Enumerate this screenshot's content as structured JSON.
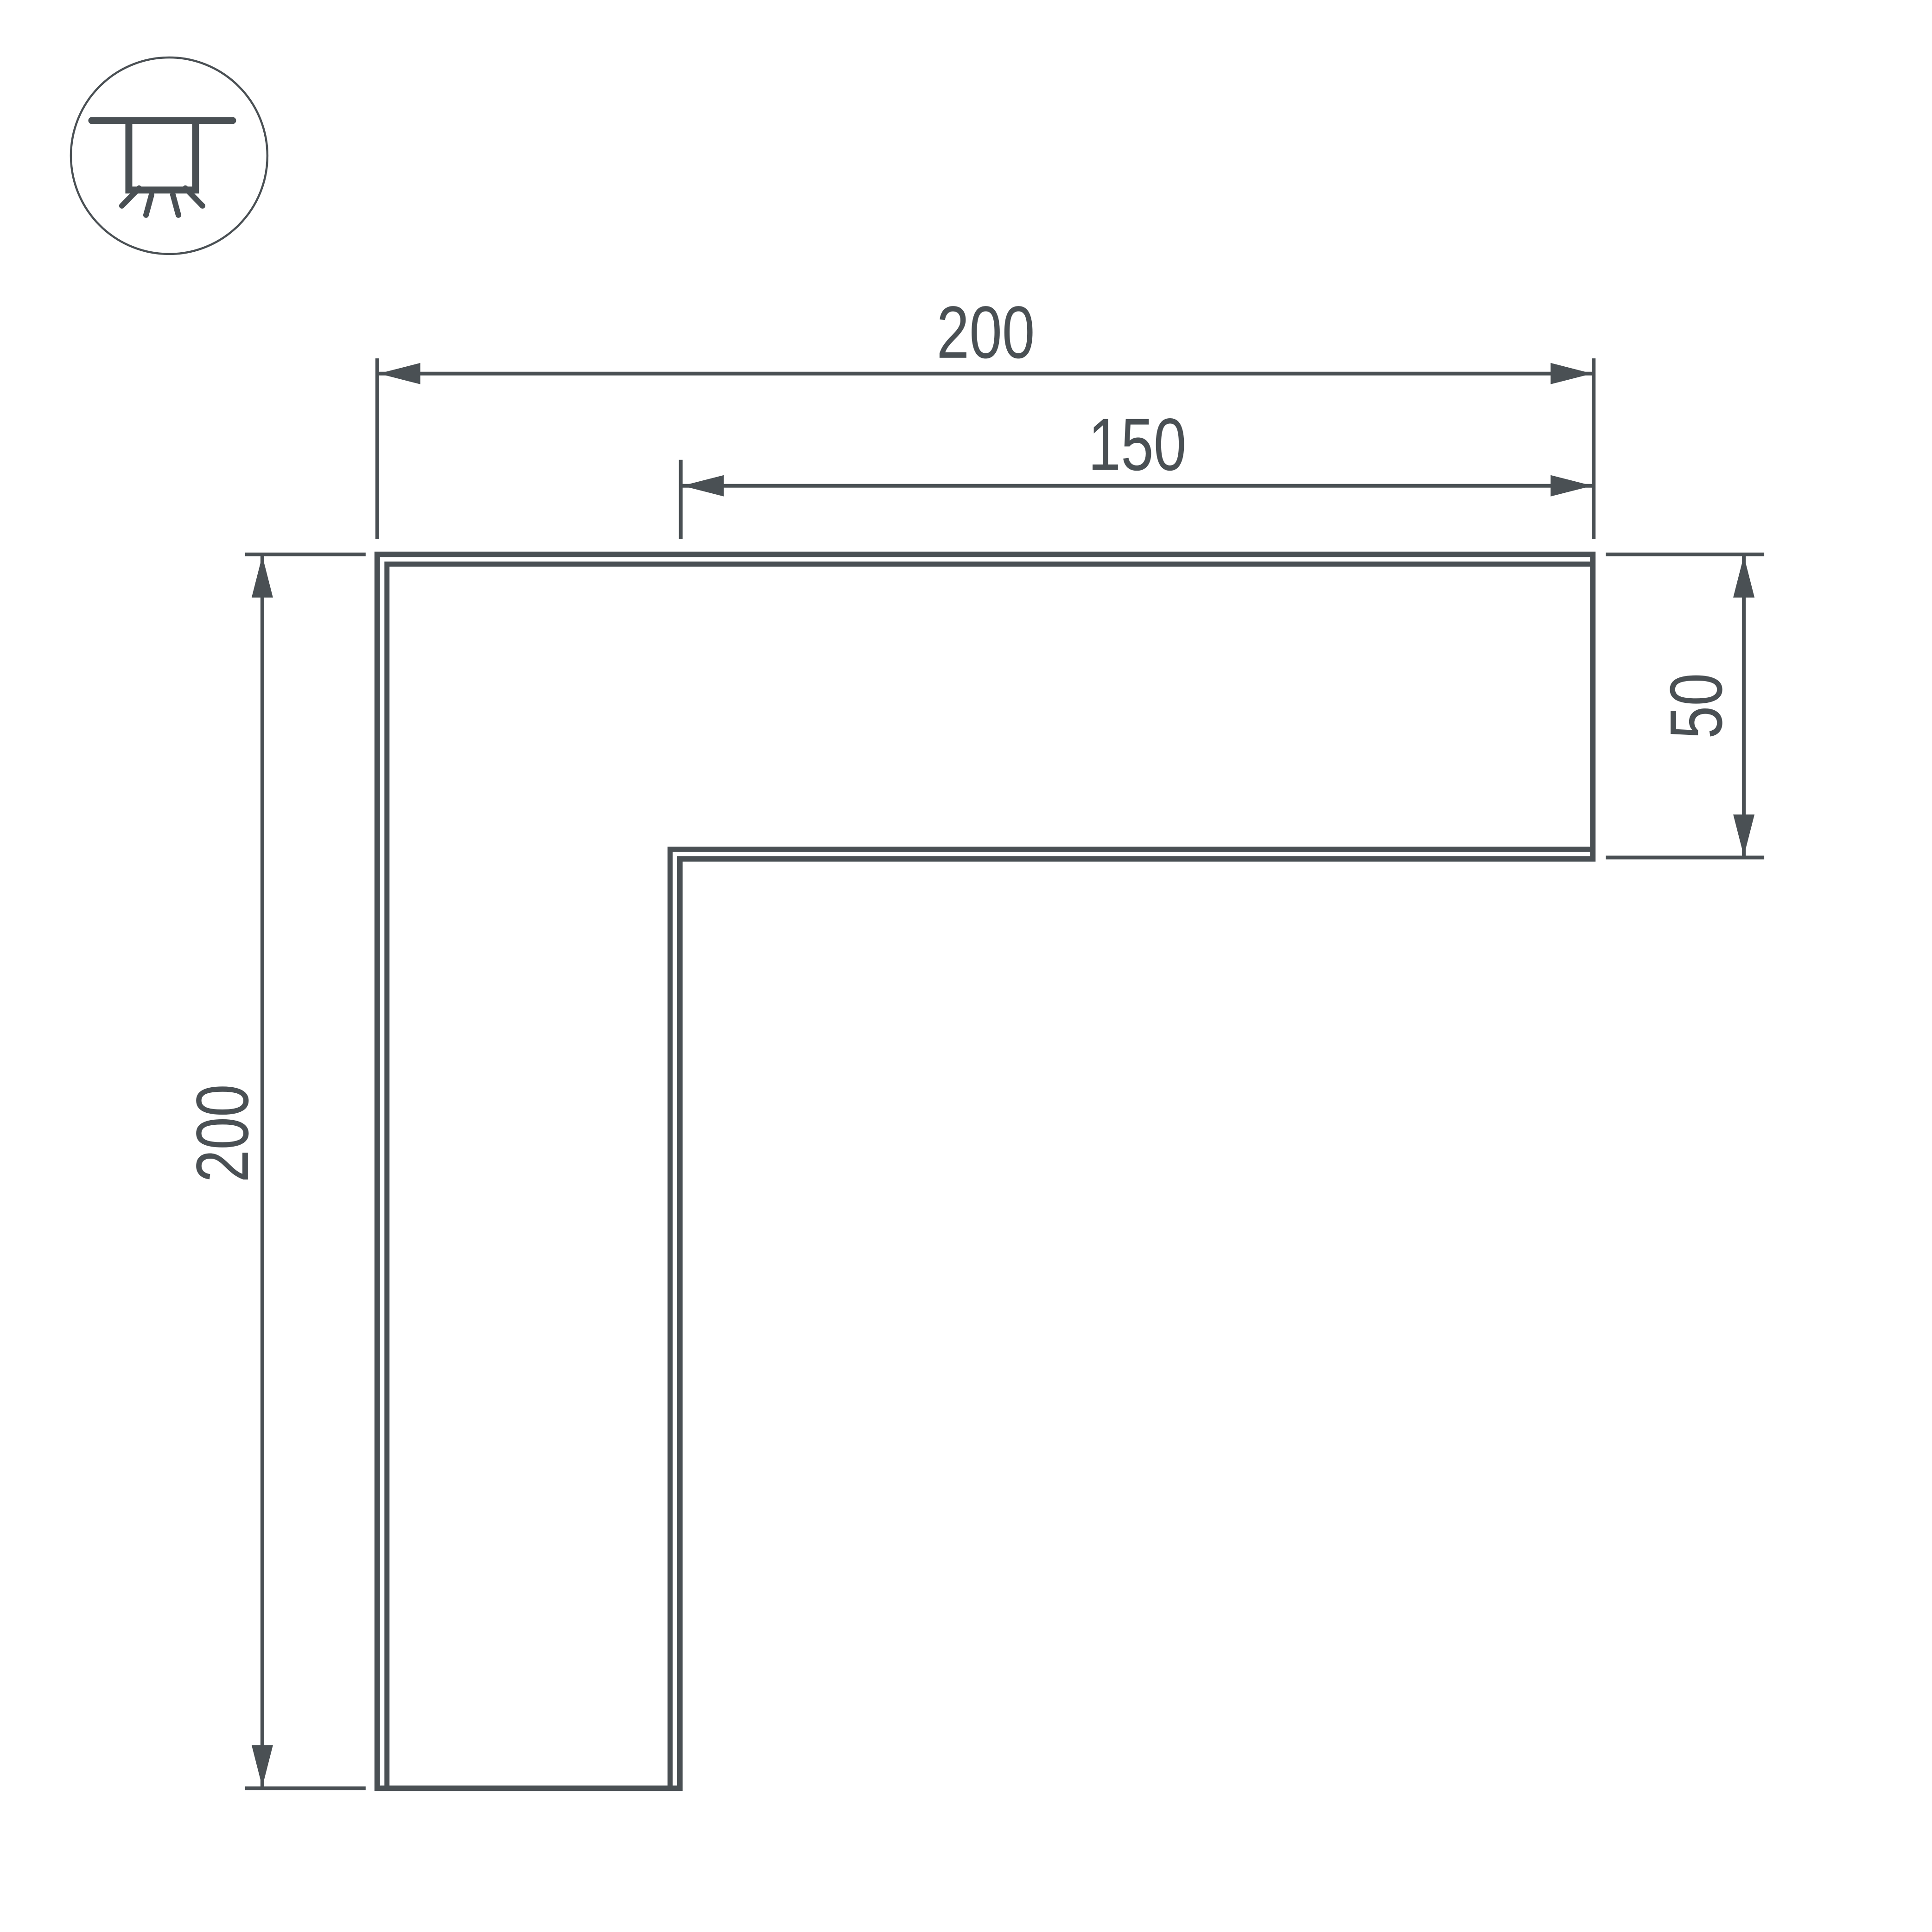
{
  "drawing": {
    "type": "technical-dimension-drawing",
    "subject": "L-shaped linear light profile corner connector, top view",
    "colors": {
      "line": "#4a5054",
      "background": "#ffffff"
    },
    "icon": {
      "name": "recessed-ceiling-light-icon",
      "description": "circle badge with ceiling line, recessed fixture and four downward light rays"
    },
    "dimensions": {
      "top_width": "200",
      "inner_width": "150",
      "arm_height": "50",
      "left_height": "200"
    }
  }
}
